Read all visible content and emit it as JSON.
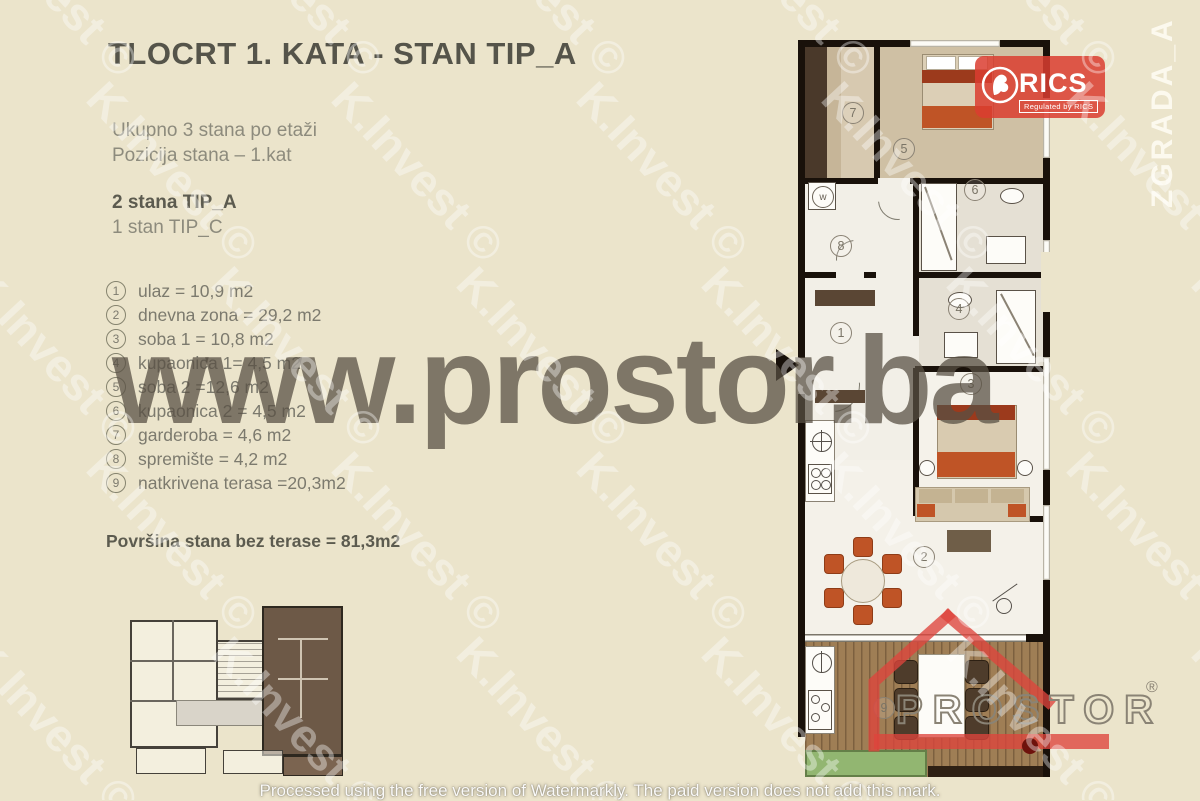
{
  "header": {
    "title": "TLOCRT 1. KATA - STAN TIP_A"
  },
  "info": {
    "line1": "Ukupno 3 stana po etaži",
    "line2": "Pozicija stana – 1.kat",
    "line3": "2 stana TIP_A",
    "line4": "1 stan TIP_C"
  },
  "rooms": [
    {
      "num": "1",
      "label": "ulaz = 10,9 m2"
    },
    {
      "num": "2",
      "label": "dnevna zona = 29,2 m2"
    },
    {
      "num": "3",
      "label": "soba 1 = 10,8 m2"
    },
    {
      "num": "4",
      "label": "kupaonica 1= 4,5 m2"
    },
    {
      "num": "5",
      "label": "soba 2 =12,6 m2"
    },
    {
      "num": "6",
      "label": "kupaonica 2 = 4,5 m2"
    },
    {
      "num": "7",
      "label": "garderoba = 4,6 m2"
    },
    {
      "num": "8",
      "label": "spremište = 4,2 m2"
    },
    {
      "num": "9",
      "label": "natkrivena terasa =20,3m2"
    }
  ],
  "summary": "Površina stana bez terase = 81,3m2",
  "plan": {
    "numbers": [
      "1",
      "2",
      "3",
      "4",
      "5",
      "6",
      "7",
      "8",
      "9"
    ],
    "washer_label": "w"
  },
  "logos": {
    "rics": {
      "name": "RICS",
      "tagline": "Regulated by RICS",
      "color": "#db3d30"
    },
    "prostor": {
      "name": "PROSTOR",
      "reg": "®",
      "color": "#df463e"
    },
    "zgrada": "ZGRADA_A"
  },
  "watermarks": {
    "tile_text": "K.Invest ©",
    "center_text": "www.prostor.ba",
    "bottom_text": "Processed using the free version of Watermarkly. The paid version does not add this mark."
  },
  "colors": {
    "background": "#ebe4cb",
    "walls": "#19110a",
    "wood_floor": "#cfc0a4",
    "deck": "#9f7e55",
    "accent_orange": "#bf5426",
    "planter_green": "#92b671"
  }
}
